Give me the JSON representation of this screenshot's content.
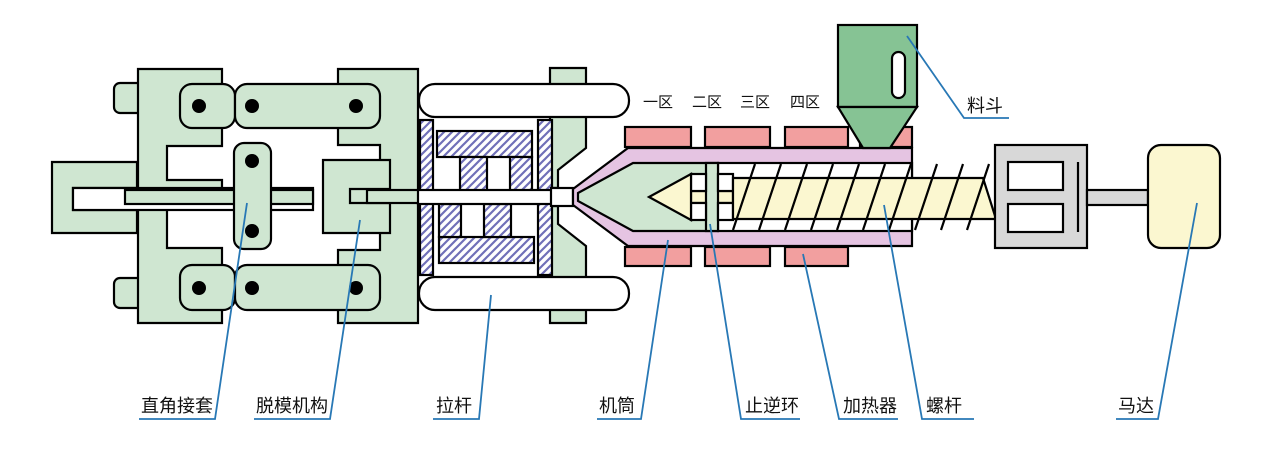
{
  "colors": {
    "body-green": "#cfe6d1",
    "hopper-green": "#86c394",
    "heater-pink": "#f29f9f",
    "barrel-lavender": "#e5c4e2",
    "screw-yellow": "#fbf7d0",
    "metal-gray": "#d8d8d8",
    "hatch-purple": "#7070b8",
    "outline-black": "#000000",
    "leader-blue": "#2878b5",
    "label-text": "#111111"
  },
  "zone_labels": [
    {
      "text": "一区",
      "x": 658,
      "y": 107
    },
    {
      "text": "二区",
      "x": 707,
      "y": 107
    },
    {
      "text": "三区",
      "x": 755,
      "y": 107
    },
    {
      "text": "四区",
      "x": 805,
      "y": 107
    }
  ],
  "part_labels": {
    "right_angle_sleeve": {
      "text": "直角接套",
      "x": 141,
      "y": 412,
      "points": "247,203 215,419 139,419"
    },
    "demolding_mechanism": {
      "text": "脱模机构",
      "x": 256,
      "y": 412,
      "points": "360,220 330,419 254,419"
    },
    "tie_rod": {
      "text": "拉杆",
      "x": 436,
      "y": 412,
      "points": "491,295 479,419 433,419"
    },
    "barrel": {
      "text": "机筒",
      "x": 599,
      "y": 412,
      "points": "668,240 641,419 597,419"
    },
    "check_ring": {
      "text": "止逆环",
      "x": 745,
      "y": 412,
      "points": "710,224 741,419 800,419"
    },
    "heater": {
      "text": "加热器",
      "x": 843,
      "y": 412,
      "points": "803,254 839,419 898,419"
    },
    "screw": {
      "text": "螺杆",
      "x": 926,
      "y": 412,
      "points": "884,205 922,419 974,419"
    },
    "motor": {
      "text": "马达",
      "x": 1118,
      "y": 412,
      "points": "1197,203 1158,419 1116,419"
    },
    "hopper": {
      "text": "料斗",
      "x": 967,
      "y": 112,
      "points": "907,36 964,118 1009,118"
    }
  }
}
